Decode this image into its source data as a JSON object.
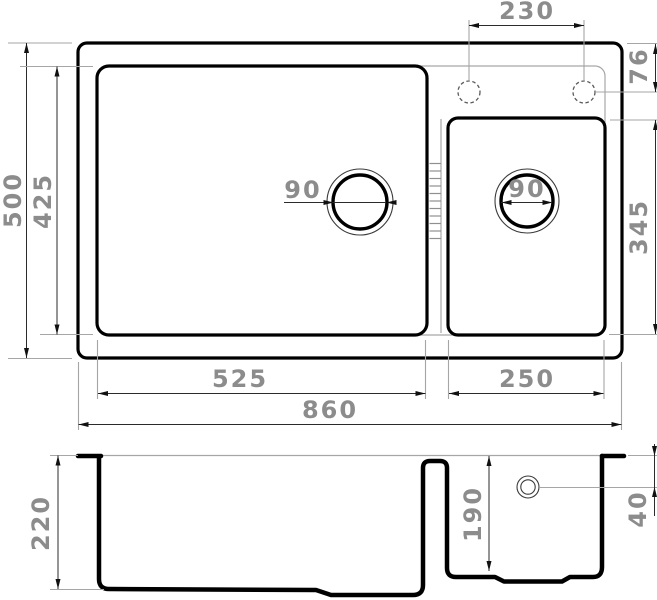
{
  "drawing": {
    "kind": "kitchen-sink-technical-drawing",
    "units": "mm",
    "views": [
      "top-view",
      "section-view"
    ]
  },
  "labels": {
    "top": {
      "faucet_spacing": "230",
      "faucet_offset": "76",
      "overall_depth": "500",
      "main_bowl_depth": "425",
      "main_drain_diameter": "90",
      "small_drain_diameter": "90",
      "small_bowl_depth": "345",
      "main_bowl_width": "525",
      "small_bowl_width": "250",
      "overall_width": "860"
    },
    "section": {
      "main_bowl_height": "220",
      "small_bowl_height": "190",
      "drain_offset": "40"
    }
  },
  "colors": {
    "line": "#000000",
    "dim_line": "#2b2b2b",
    "extension_line": "#a6a6a6",
    "dim_text": "#8c8c8c",
    "background": "#ffffff"
  }
}
